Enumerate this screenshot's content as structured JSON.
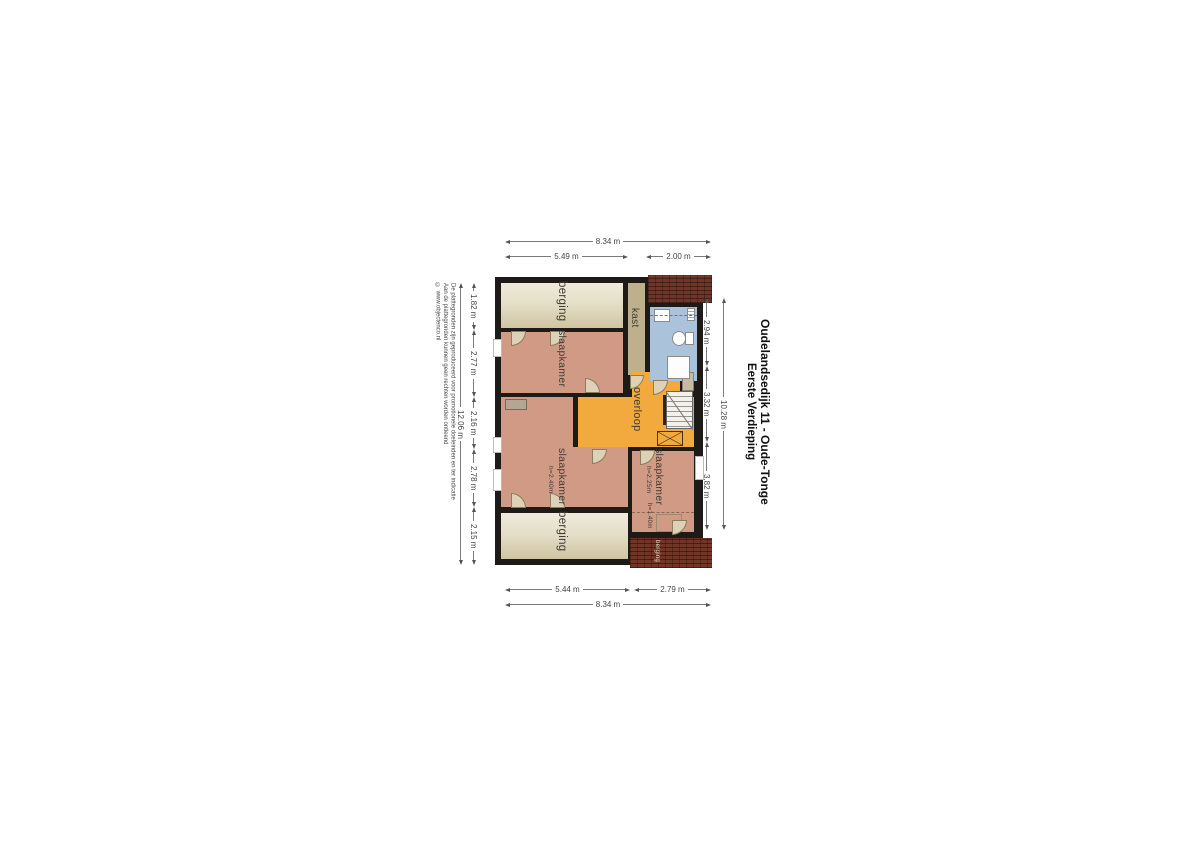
{
  "title": {
    "line1": "Oudelandsedijk 11 - Oude-Tonge",
    "line2": "Eerste Verdieping"
  },
  "disclaimer": {
    "line1": "De plattegronden zijn geproduceerd voor promotionele doeleinden en ter indicatie",
    "line2": "Aan de plattegronden kunnen geen rechten worden ontleend",
    "line3": "© www.objectenco.nl"
  },
  "rooms": {
    "berging_top": "berging",
    "kast": "kast",
    "slaapkamer_main": "slaapkamer",
    "overloop": "overloop",
    "slaapkamer_left": "slaapkamer",
    "slaapkamer_left_height": "h=2.40m",
    "slaapkamer_right": "slaapkamer",
    "slaapkamer_right_height": "h=2.25m",
    "knee_wall_height": "h=1.40m",
    "berging_bottom": "berging",
    "berging_exterior": "berging"
  },
  "dimensions": {
    "top": {
      "total": "8.34 m",
      "seg1": "5.49 m",
      "seg2": "2.00 m"
    },
    "bottom": {
      "seg1": "5.44 m",
      "seg2": "2.79 m",
      "total": "8.34 m"
    },
    "left": {
      "seg1": "1.82 m",
      "seg2": "2.77 m",
      "seg3": "2.16 m",
      "seg4": "2.78 m",
      "seg5": "2.15 m",
      "total": "12.06 m"
    },
    "right": {
      "seg1": "2.94 m",
      "seg2": "3.32 m",
      "seg3": "3.82 m",
      "total": "10.28 m"
    }
  },
  "colors": {
    "wall": "#1d1a17",
    "bedroom": "#d09a84",
    "storage_light": "#eee9da",
    "storage_dark": "#d0c4a1",
    "closet": "#beb08d",
    "landing": "#f2a93d",
    "bathroom_floor": "#aac3da",
    "brick": "#703527",
    "door": "#ddd2b8"
  }
}
